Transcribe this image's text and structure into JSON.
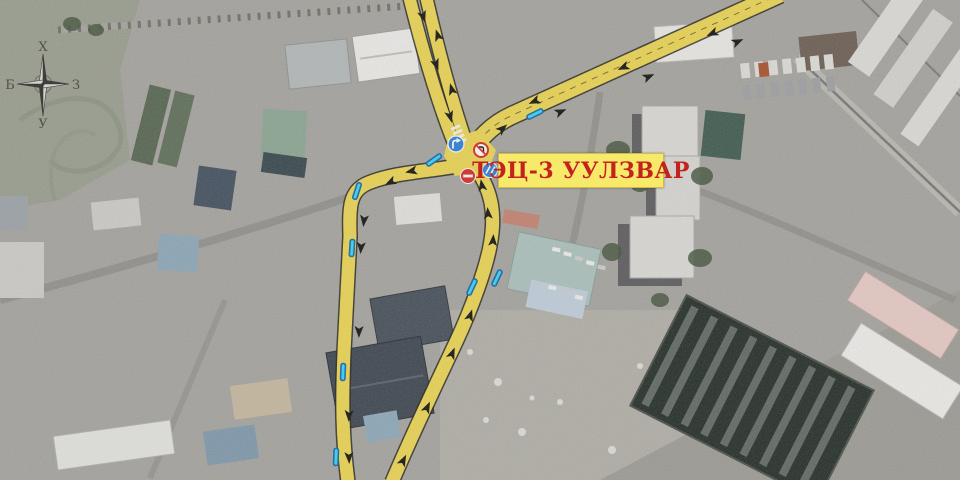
{
  "map": {
    "label": {
      "text": "ТЭЦ-3 УУЛЗВАР",
      "bg": "#f7e96a",
      "color": "#c4231d"
    },
    "compass": {
      "north": "Х",
      "south": "У",
      "west": "Б",
      "east": "З"
    },
    "colors": {
      "route_yellow": "#e6d052",
      "route_casing": "#26261d",
      "arrow": "#141411",
      "tick_fill": "#3ecdf0",
      "tick_border": "#1467a8",
      "sign_blue": "#2e7ed2",
      "sign_red": "#d42b24",
      "sign_white": "#f5f3ee"
    },
    "annotations": {
      "arrows": [
        [
          423,
          16,
          162
        ],
        [
          436,
          64,
          160
        ],
        [
          450,
          116,
          164
        ],
        [
          438,
          36,
          -18
        ],
        [
          452,
          90,
          -16
        ],
        [
          502,
          129,
          48
        ],
        [
          560,
          112,
          66
        ],
        [
          648,
          77,
          66
        ],
        [
          737,
          42,
          66
        ],
        [
          535,
          101,
          246
        ],
        [
          624,
          67,
          246
        ],
        [
          713,
          33,
          246
        ],
        [
          412,
          171,
          258
        ],
        [
          391,
          182,
          243
        ],
        [
          364,
          220,
          186
        ],
        [
          361,
          247,
          184
        ],
        [
          359,
          331,
          181
        ],
        [
          349,
          415,
          182
        ],
        [
          349,
          457,
          178
        ],
        [
          482,
          186,
          -10
        ],
        [
          488,
          214,
          -4
        ],
        [
          493,
          241,
          4
        ],
        [
          470,
          316,
          18
        ],
        [
          452,
          354,
          23
        ],
        [
          427,
          408,
          25
        ],
        [
          403,
          461,
          27
        ]
      ],
      "stop_ticks": [
        [
          535,
          114,
          64
        ],
        [
          434,
          160,
          55
        ],
        [
          357,
          191,
          18
        ],
        [
          352,
          248,
          4
        ],
        [
          343,
          372,
          2
        ],
        [
          336,
          457,
          2
        ],
        [
          472,
          287,
          25
        ],
        [
          497,
          278,
          25
        ]
      ],
      "signs": [
        {
          "type": "no-entry-sign",
          "x": 468,
          "y": 176
        },
        {
          "type": "turn-right-sign",
          "x": 456,
          "y": 144
        },
        {
          "type": "no-turn-sign",
          "x": 481,
          "y": 150
        },
        {
          "type": "lane-permit-sign",
          "x": 490,
          "y": 170
        }
      ]
    }
  }
}
